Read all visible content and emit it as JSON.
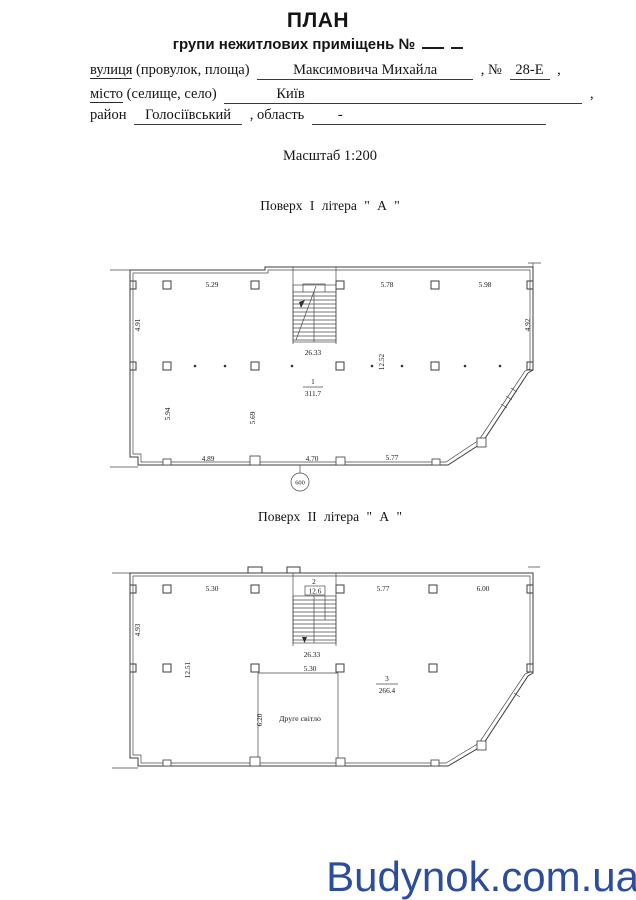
{
  "header": {
    "title": "ПЛАН",
    "subtitle": "групи нежитлових приміщень №"
  },
  "form": {
    "street_label_u": "вулиця",
    "street_label_rest": " (провулок, площа)",
    "street_value": "Максимовича Михайла",
    "no_label": ", №",
    "no_value": "28-Е",
    "comma": ",",
    "city_label_u": "місто",
    "city_label_rest": " (селище, село)",
    "city_value": "Київ",
    "district_label": "район",
    "district_value": "Голосіївський",
    "region_label": ", область",
    "region_value": "-"
  },
  "scale_label": "Масштаб 1:200",
  "floor1": {
    "caption": "Поверх  I  літера  \" А \"",
    "dims_top": [
      "5.29",
      "5.78",
      "5.98"
    ],
    "dim_left": "4.91",
    "dim_right": "4.92",
    "stair_width": "26.33",
    "dim_mid_vertical": "12.52",
    "room_number": "1",
    "room_area": "311.7",
    "dim_inner_left": "5.94",
    "dim_inner_mid": "5.69",
    "dims_bottom": [
      "4.89",
      "4.70",
      "5.77"
    ],
    "axis_mark": "600"
  },
  "floor2": {
    "caption": "Поверх  II  літера  \" А \"",
    "dims_top": [
      "5.30",
      "5.77",
      "6.00"
    ],
    "dim_left": "4.93",
    "stair_room_number": "2",
    "stair_room_area": "12.6",
    "stair_width": "26.33",
    "dim_mid_vertical": "12.51",
    "dim_void_top": "5.30",
    "room_number": "3",
    "room_area": "266.4",
    "void_height": "6.20",
    "void_label": "Друге світло"
  },
  "watermark": "Budynok.com.ua",
  "colors": {
    "watermark_blue": "#2c4d9d",
    "line": "#3d3d3d"
  }
}
